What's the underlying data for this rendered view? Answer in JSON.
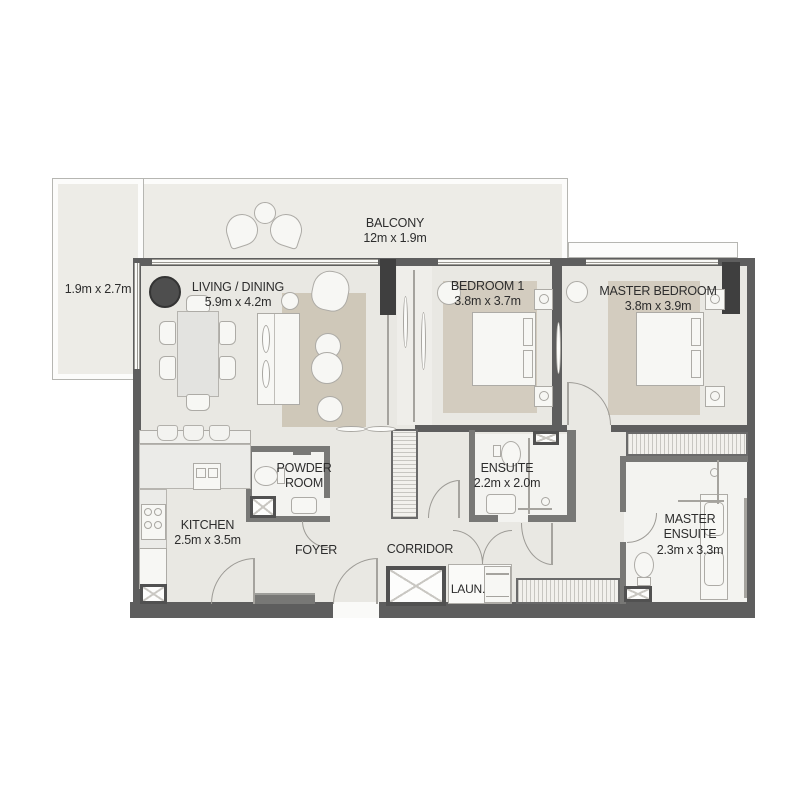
{
  "plan": {
    "title": "2 Bedroom Apartment Floor Plan",
    "rooms": {
      "balcony": {
        "name": "BALCONY",
        "dims": "12m x 1.9m"
      },
      "side_balcony": {
        "dims": "1.9m x 2.7m"
      },
      "living_dining": {
        "name": "LIVING / DINING",
        "dims": "5.9m x 4.2m"
      },
      "bedroom1": {
        "name": "BEDROOM 1",
        "dims": "3.8m x 3.7m"
      },
      "master_bedroom": {
        "name": "MASTER BEDROOM",
        "dims": "3.8m x 3.9m"
      },
      "powder_room": {
        "name": "POWDER ROOM"
      },
      "ensuite": {
        "name": "ENSUITE",
        "dims": "2.2m x 2.0m"
      },
      "kitchen": {
        "name": "KITCHEN",
        "dims": "2.5m x 3.5m"
      },
      "foyer": {
        "name": "FOYER"
      },
      "corridor": {
        "name": "CORRIDOR"
      },
      "laundry": {
        "name": "LAUN."
      },
      "master_ensuite": {
        "name": "MASTER ENSUITE",
        "dims": "2.3m x 3.3m"
      }
    },
    "colors": {
      "wall": "#5e5e5e",
      "wall_dark": "#3f3f3f",
      "floor": "#e9e8e3",
      "balcony_floor": "#edece7",
      "bath_floor": "#f3f3f0",
      "rug": "#cfc8b9",
      "text": "#2d2d2d"
    }
  }
}
